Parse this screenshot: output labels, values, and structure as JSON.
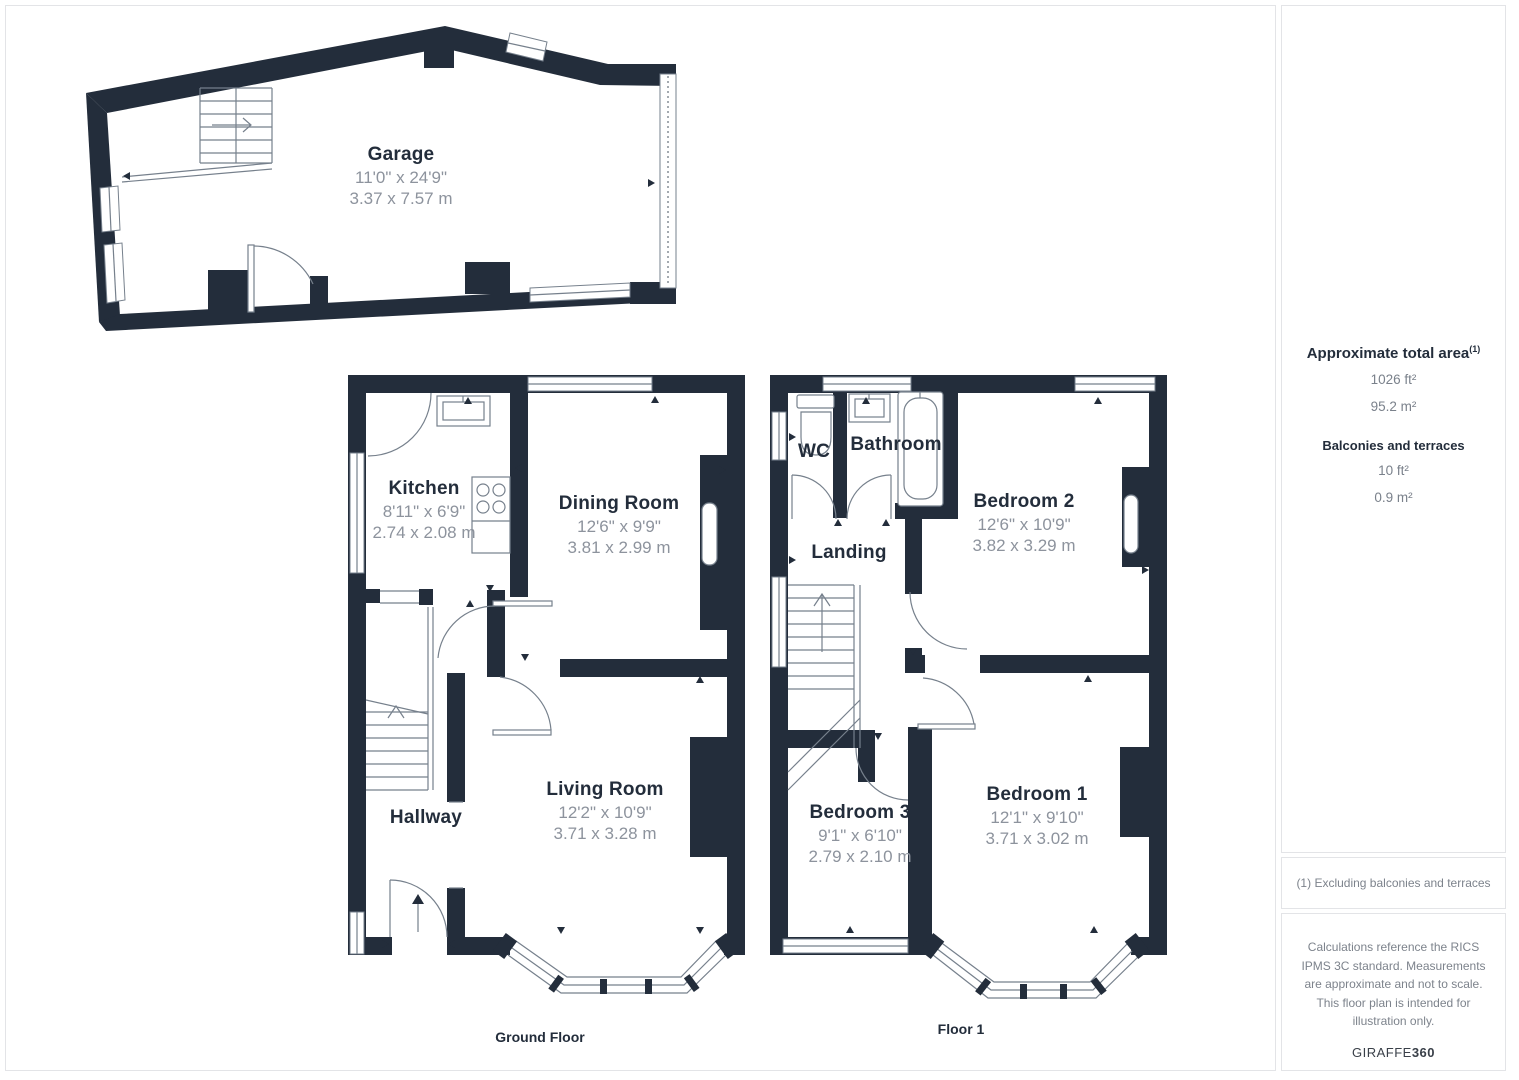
{
  "rooms": {
    "garage": {
      "name": "Garage",
      "imperial": "11'0\" x 24'9\"",
      "metric": "3.37 x 7.57 m"
    },
    "kitchen": {
      "name": "Kitchen",
      "imperial": "8'11\" x 6'9\"",
      "metric": "2.74 x 2.08 m"
    },
    "dining_room": {
      "name": "Dining Room",
      "imperial": "12'6\" x 9'9\"",
      "metric": "3.81 x 2.99 m"
    },
    "living_room": {
      "name": "Living Room",
      "imperial": "12'2\" x 10'9\"",
      "metric": "3.71 x 3.28 m"
    },
    "hallway": {
      "name": "Hallway"
    },
    "wc": {
      "name": "WC"
    },
    "bathroom": {
      "name": "Bathroom"
    },
    "landing": {
      "name": "Landing"
    },
    "bedroom_2": {
      "name": "Bedroom 2",
      "imperial": "12'6\" x 10'9\"",
      "metric": "3.82 x 3.29 m"
    },
    "bedroom_3": {
      "name": "Bedroom 3",
      "imperial": "9'1\" x 6'10\"",
      "metric": "2.79 x 2.10 m"
    },
    "bedroom_1": {
      "name": "Bedroom 1",
      "imperial": "12'1\" x 9'10\"",
      "metric": "3.71 x 3.02 m"
    }
  },
  "floors": {
    "ground": "Ground Floor",
    "first": "Floor 1"
  },
  "sidebar": {
    "total_area_title": "Approximate total area",
    "total_area_superscript": "(1)",
    "total_area_ft": "1026 ft²",
    "total_area_m": "95.2 m²",
    "balconies_title": "Balconies and terraces",
    "balconies_ft": "10 ft²",
    "balconies_m": "0.9 m²",
    "footnote": "(1) Excluding balconies and terraces",
    "disclaimer": "Calculations reference the RICS IPMS 3C standard. Measurements are approximate and not to scale. This floor plan is intended for illustration only.",
    "brand_name": "GIRAFFE",
    "brand_number": "360"
  },
  "colors": {
    "wall": "#232d3b",
    "thin": "#76808c",
    "title": "#232d3b",
    "dims": "#8d939d",
    "border": "#e3e4e7",
    "muted": "#7d838c",
    "brand": "#3a4049"
  }
}
